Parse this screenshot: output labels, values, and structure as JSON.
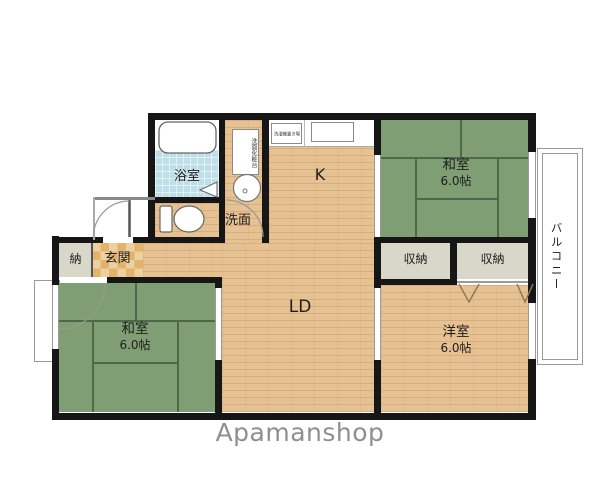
{
  "brand": "Apamanshop",
  "rooms": {
    "bath": {
      "label": "浴室"
    },
    "washroom": {
      "label": "洗面"
    },
    "vanity": {
      "label": "洗面化粧台"
    },
    "laundry": {
      "label": "洗濯機置き場"
    },
    "kitchen": {
      "label": "K"
    },
    "living_dining": {
      "label": "LD"
    },
    "japanese_room_ne": {
      "label": "和室",
      "size": "6.0帖"
    },
    "japanese_room_sw": {
      "label": "和室",
      "size": "6.0帖"
    },
    "western_room": {
      "label": "洋室",
      "size": "6.0帖"
    },
    "closet_a": {
      "label": "収納"
    },
    "closet_b": {
      "label": "収納"
    },
    "storage": {
      "label": "納"
    },
    "entrance": {
      "label": "玄関"
    },
    "balcony": {
      "label": "バルコニー"
    }
  },
  "colors": {
    "wall": "#161616",
    "wood_floor": "#e6c192",
    "tatami": "#7f9e74",
    "tatami_line": "#50684a",
    "bath_tile": "#bedee8",
    "closet_fill": "#d9d6ca",
    "entrance_tile_light": "#edd0a0",
    "entrance_tile_dark": "#e3b26b",
    "brand_text": "#8f8f8f"
  }
}
